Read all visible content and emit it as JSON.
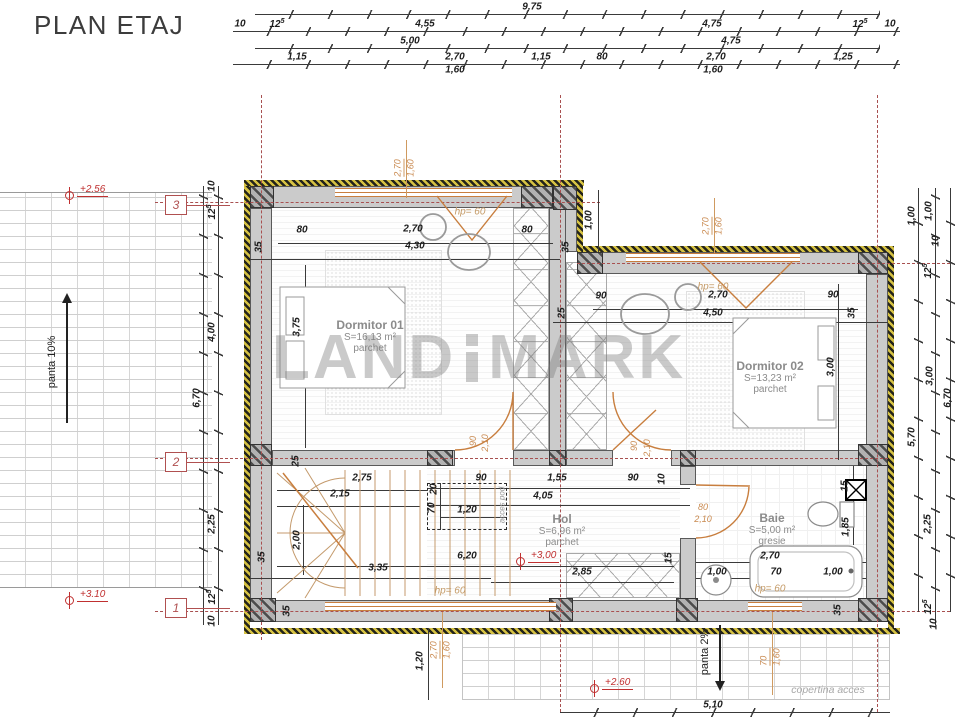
{
  "title": "PLAN ETAJ",
  "watermark": {
    "left": "LAND",
    "right": "MARK"
  },
  "rooms": [
    {
      "name": "Dormitor 01",
      "area": "S=16,13 m²",
      "floor": "parchet",
      "x": 370,
      "y": 336
    },
    {
      "name": "Dormitor 02",
      "area": "S=13,23 m²",
      "floor": "parchet",
      "x": 770,
      "y": 377
    },
    {
      "name": "Hol",
      "area": "S=6,96 m²",
      "floor": "parchet",
      "x": 562,
      "y": 530
    },
    {
      "name": "Baie",
      "area": "S=5,00 m²",
      "floor": "gresie",
      "x": 772,
      "y": 529
    }
  ],
  "axes": [
    {
      "n": "3",
      "y": 205
    },
    {
      "n": "2",
      "y": 462
    },
    {
      "n": "1",
      "y": 608
    }
  ],
  "levels": [
    {
      "t": "+2.56",
      "x": 65,
      "y": 191
    },
    {
      "t": "+3.10",
      "x": 65,
      "y": 596
    },
    {
      "t": "+3,00",
      "x": 516,
      "y": 557
    },
    {
      "t": "+2.60",
      "x": 590,
      "y": 684
    }
  ],
  "slopes": {
    "roof": "panta 10%",
    "canopy": "panta 2%"
  },
  "canopy_label": "copertina acces",
  "hp": [
    {
      "t": "hp= 60",
      "x": 470,
      "y": 212
    },
    {
      "t": "hp= 60",
      "x": 713,
      "y": 287
    },
    {
      "t": "hp= 60",
      "x": 450,
      "y": 591
    },
    {
      "t": "hp= 60",
      "x": 770,
      "y": 589
    }
  ],
  "win_callouts": [
    {
      "a": "2,70",
      "b": "1,60",
      "x": 404,
      "y": 168
    },
    {
      "a": "2,70",
      "b": "1,60",
      "x": 712,
      "y": 226
    },
    {
      "a": "2,70",
      "b": "1,60",
      "x": 440,
      "y": 650
    },
    {
      "a": "70",
      "b": "1,60",
      "x": 770,
      "y": 657
    }
  ],
  "dims": [
    {
      "t": "9,75",
      "x": 532,
      "y": 7
    },
    {
      "t": "10",
      "x": 240,
      "y": 24
    },
    {
      "t": "12",
      "s": "5",
      "x": 277,
      "y": 24
    },
    {
      "t": "4,55",
      "x": 425,
      "y": 24
    },
    {
      "t": "4,75",
      "x": 712,
      "y": 24
    },
    {
      "t": "12",
      "s": "5",
      "x": 860,
      "y": 24
    },
    {
      "t": "10",
      "x": 890,
      "y": 24
    },
    {
      "t": "5,00",
      "x": 410,
      "y": 41
    },
    {
      "t": "4,75",
      "x": 731,
      "y": 41
    },
    {
      "t": "1,15",
      "x": 297,
      "y": 57
    },
    {
      "t": "2,70",
      "x": 455,
      "y": 57
    },
    {
      "t": "1,15",
      "x": 541,
      "y": 57
    },
    {
      "t": "80",
      "x": 602,
      "y": 57
    },
    {
      "t": "2,70",
      "x": 716,
      "y": 57
    },
    {
      "t": "1,25",
      "x": 843,
      "y": 57
    },
    {
      "t": "1,60",
      "x": 455,
      "y": 70
    },
    {
      "t": "1,60",
      "x": 713,
      "y": 70
    },
    {
      "t": "10",
      "x": 212,
      "y": 186,
      "r": 1
    },
    {
      "t": "12",
      "s": "5",
      "x": 212,
      "y": 212,
      "r": 1
    },
    {
      "t": "4,00",
      "x": 212,
      "y": 332,
      "r": 1
    },
    {
      "t": "6,70",
      "x": 197,
      "y": 398,
      "r": 1
    },
    {
      "t": "2,25",
      "x": 212,
      "y": 524,
      "r": 1
    },
    {
      "t": "12",
      "s": "5",
      "x": 212,
      "y": 597,
      "r": 1
    },
    {
      "t": "10",
      "x": 212,
      "y": 621,
      "r": 1
    },
    {
      "t": "1,00",
      "x": 912,
      "y": 216,
      "r": 1
    },
    {
      "t": "1,00",
      "x": 929,
      "y": 211,
      "r": 1
    },
    {
      "t": "10",
      "x": 936,
      "y": 241,
      "r": 1
    },
    {
      "t": "12",
      "s": "5",
      "x": 928,
      "y": 271,
      "r": 1
    },
    {
      "t": "3,00",
      "x": 930,
      "y": 376,
      "r": 1
    },
    {
      "t": "5,70",
      "x": 912,
      "y": 437,
      "r": 1
    },
    {
      "t": "6,70",
      "x": 948,
      "y": 398,
      "r": 1
    },
    {
      "t": "2,25",
      "x": 928,
      "y": 524,
      "r": 1
    },
    {
      "t": "12",
      "s": "5",
      "x": 928,
      "y": 607,
      "r": 1
    },
    {
      "t": "10",
      "x": 934,
      "y": 624,
      "r": 1
    },
    {
      "t": "5,10",
      "x": 713,
      "y": 705
    },
    {
      "t": "1,20",
      "x": 420,
      "y": 661,
      "r": 1
    },
    {
      "t": "80",
      "x": 302,
      "y": 230
    },
    {
      "t": "2,70",
      "x": 413,
      "y": 229
    },
    {
      "t": "80",
      "x": 527,
      "y": 230
    },
    {
      "t": "4,30",
      "x": 415,
      "y": 246
    },
    {
      "t": "35",
      "x": 259,
      "y": 247,
      "r": 1
    },
    {
      "t": "35",
      "x": 566,
      "y": 247,
      "r": 1
    },
    {
      "t": "3,75",
      "x": 297,
      "y": 327,
      "r": 1
    },
    {
      "t": "25",
      "x": 296,
      "y": 461,
      "r": 1
    },
    {
      "t": "1,00",
      "x": 589,
      "y": 220,
      "r": 1
    },
    {
      "t": "90",
      "x": 601,
      "y": 296
    },
    {
      "t": "2,70",
      "x": 718,
      "y": 295
    },
    {
      "t": "90",
      "x": 833,
      "y": 295
    },
    {
      "t": "25",
      "x": 562,
      "y": 313,
      "r": 1
    },
    {
      "t": "4,50",
      "x": 713,
      "y": 313
    },
    {
      "t": "35",
      "x": 852,
      "y": 313,
      "r": 1
    },
    {
      "t": "3,00",
      "x": 831,
      "y": 367,
      "r": 1
    },
    {
      "t": "2,75",
      "x": 362,
      "y": 478
    },
    {
      "t": "2,15",
      "x": 340,
      "y": 494
    },
    {
      "t": "2,00",
      "x": 297,
      "y": 540,
      "r": 1
    },
    {
      "t": "90",
      "x": 481,
      "y": 478
    },
    {
      "t": "1,55",
      "x": 557,
      "y": 478
    },
    {
      "t": "90",
      "x": 633,
      "y": 478
    },
    {
      "t": "10",
      "x": 662,
      "y": 479,
      "r": 1
    },
    {
      "t": "4,05",
      "x": 543,
      "y": 496
    },
    {
      "t": "20",
      "x": 434,
      "y": 489,
      "r": 1
    },
    {
      "t": "70",
      "x": 432,
      "y": 508,
      "r": 1
    },
    {
      "t": "1,20",
      "x": 467,
      "y": 510
    },
    {
      "t": "6,20",
      "x": 467,
      "y": 556
    },
    {
      "t": "3,35",
      "x": 378,
      "y": 568
    },
    {
      "t": "2,85",
      "x": 582,
      "y": 572
    },
    {
      "t": "35",
      "x": 262,
      "y": 557,
      "r": 1
    },
    {
      "t": "35",
      "x": 287,
      "y": 611,
      "r": 1
    },
    {
      "t": "15",
      "x": 845,
      "y": 486,
      "r": 1
    },
    {
      "t": "1,85",
      "x": 846,
      "y": 527,
      "r": 1
    },
    {
      "t": "2,70",
      "x": 770,
      "y": 556
    },
    {
      "t": "70",
      "x": 776,
      "y": 572
    },
    {
      "t": "1,00",
      "x": 833,
      "y": 572
    },
    {
      "t": "1,00",
      "x": 717,
      "y": 572
    },
    {
      "t": "15",
      "x": 669,
      "y": 558,
      "r": 1
    },
    {
      "t": "35",
      "x": 838,
      "y": 610,
      "r": 1
    },
    {
      "t": "90",
      "x": 473,
      "y": 441,
      "r": 1,
      "o": 1
    },
    {
      "t": "2,10",
      "x": 485,
      "y": 443,
      "r": 1,
      "o": 1
    },
    {
      "t": "90",
      "x": 634,
      "y": 446,
      "r": 1,
      "o": 1
    },
    {
      "t": "2,10",
      "x": 647,
      "y": 448,
      "r": 1,
      "o": 1
    },
    {
      "t": "80",
      "x": 703,
      "y": 507,
      "o": 1
    },
    {
      "t": "2,10",
      "x": 703,
      "y": 519,
      "o": 1
    },
    {
      "t": "acces pod",
      "x": 502,
      "y": 505,
      "r": 1,
      "g": 1
    }
  ]
}
